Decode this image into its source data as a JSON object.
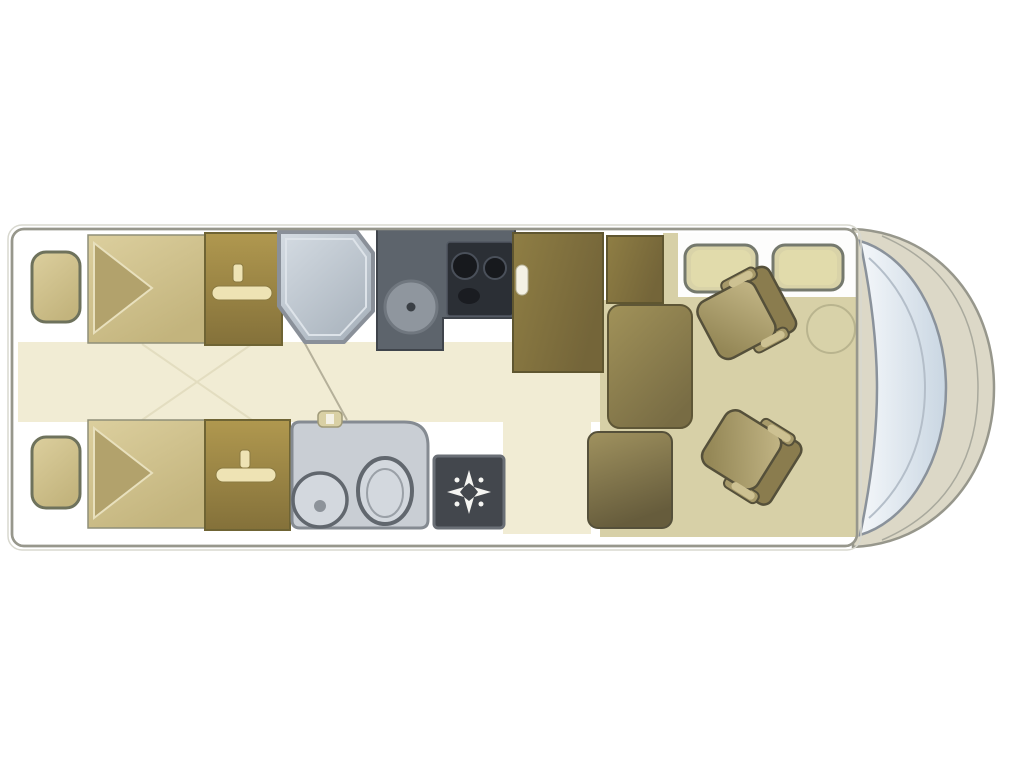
{
  "page": {
    "background": "#ffffff",
    "kind": "motorhome-floorplan"
  },
  "colors": {
    "wall_line": "#97978c",
    "hull_faint": "#d8d8cf",
    "body_shell": "#dcd8c7",
    "body_rim": "#a9a99d",
    "floor_cream": "#f1ecd4",
    "floor_khaki": "#d7d0a7",
    "floor_seam": "#e3ddc0",
    "door_line": "#b5b09a",
    "platform_white": "#fdfdfc",
    "bed_light": "#dccf9e",
    "bed_dark": "#c3b47d",
    "bed_border": "#8f8f78",
    "pillow": "#b2a26c",
    "pillow_edge": "#e8e0bd",
    "nightstand_fill": "#cdbf8a",
    "nightstand_border": "#6e725c",
    "wardrobe_light": "#b0984f",
    "wardrobe_dark": "#84713a",
    "wardrobe_border": "#6f6434",
    "hanger": "#eee3b4",
    "hanger_edge": "#8a7a42",
    "shower_light": "#d5dce3",
    "shower_dark": "#a9b3bd",
    "shower_border": "#8a9099",
    "shower_inner": "#dde3e9",
    "kitchen": "#5d646c",
    "kitchen_border": "#3f444b",
    "stove": "#2b2f35",
    "stove_border": "#515761",
    "burner": "#17191d",
    "burner_rim": "#4a505a",
    "sink": "#8f969e",
    "sink_border": "#70777f",
    "sink_dot": "#3a3f45",
    "fridge_light": "#8f7e44",
    "fridge_dark": "#746539",
    "fridge_border": "#5f5630",
    "handle": "#f4f1e4",
    "handle_edge": "#b9b49a",
    "bath_unit": "#c9ced4",
    "bath_border": "#858b92",
    "fixture_border": "#61676e",
    "fixture_fill": "#d3d8de",
    "fixture_inner": "#9aa0a7",
    "drain": "#8d939a",
    "tap": "#d9d0a4",
    "tap_edge": "#a09a78",
    "tray": "#43474d",
    "tray_border": "#6a6f76",
    "star": "#f5f5f2",
    "table_light": "#a19259",
    "table_dark": "#786c44",
    "table_border": "#5e5636",
    "bench_light": "#a0925f",
    "bench_dark": "#665c3c",
    "bench_border": "#55503a",
    "headrest": "#d9d3a8",
    "headrest_inner": "#e4dead",
    "headrest_border": "#75796d",
    "cushion_light": "#c4b787",
    "cushion_dark": "#948756",
    "seat_back": "#8a7c4e",
    "armrest": "#a79a6a",
    "armrest_pad": "#cdc192",
    "seat_outline": "#55503a",
    "circle_fill": "#d9d3aa",
    "circle_edge": "#b6b18c",
    "windshield_light": "#f4f7fa",
    "windshield_dark": "#c9d6e2",
    "windshield_edge": "#8a929b",
    "windshield_line": "#b4bec9"
  },
  "items": {
    "vehicle": "Motorhome floor plan",
    "bed_top": "Single bed (top)",
    "bed_bottom": "Single bed (bottom)",
    "nightstand_top": "Bedside cabinet (top)",
    "nightstand_bottom": "Bedside cabinet (bottom)",
    "wardrobe_top": "Wardrobe with hanger (top)",
    "wardrobe_bottom": "Wardrobe with hanger (bottom)",
    "shower": "Shower cubicle",
    "kitchen": "Kitchen unit with sink and hob",
    "stove": "Two-burner hob",
    "kitchen_sink": "Round kitchen sink",
    "fridge": "Refrigerator / tall cabinet",
    "cabinet": "Storage cabinet",
    "bathroom": "Washroom with basin and toilet",
    "basin": "Round wash basin",
    "toilet": "Toilet",
    "tap": "Basin tap",
    "tray": "Shower tray with drain",
    "table": "Dinette table",
    "bench": "Lounge bench seat",
    "headrest_left": "Travel seat (left)",
    "headrest_right": "Travel seat (right)",
    "chair_top": "Swivel cab seat (top)",
    "chair_bottom": "Swivel cab seat (bottom)",
    "cab_circle": "Seat swivel base",
    "windshield": "Windscreen",
    "nose": "Vehicle front body"
  }
}
